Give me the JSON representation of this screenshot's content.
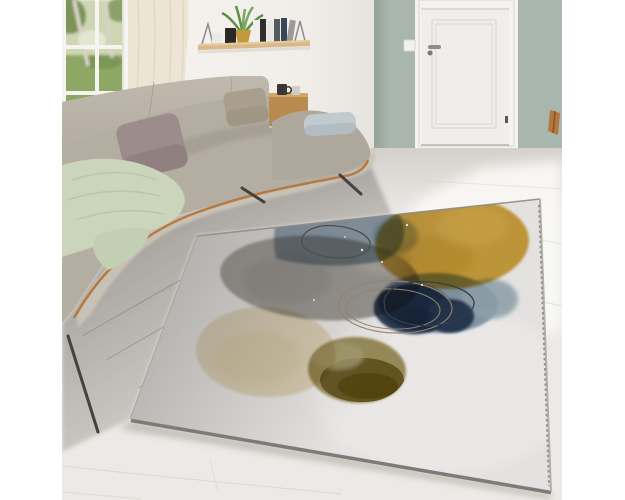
{
  "meta": {
    "alt": "Living room product photo: gray sectional sofa by a window, sage green wall with white door, and a light gray area rug with abstract watercolor circles in yellow, gray, blue, navy, cream and olive",
    "image_width": 625,
    "image_height": 500
  },
  "palette": {
    "margin": "#ffffff",
    "back_wall": "#f4f2ee",
    "accent_wall": "#a9b6ae",
    "wall_base_line": "#8e9a90",
    "floor": "#eceae6",
    "floor_seam": "#d9d6d0",
    "floor_shadow": "#76726c",
    "sunlight": "#faf9f6",
    "door": "#efeeea",
    "door_frame": "#f4f3f0",
    "door_handle": "#8f8d8a",
    "door_catch": "#5b5955",
    "light_switch": "#f2f1ee",
    "curtain": "#ece4d4",
    "curtain_fold": "#dcd1ba",
    "window_frame": "#f5f4f1",
    "window_sill": "#f3f2ef",
    "garden_light": "#cdd5b2",
    "garden_lawn": "#8fa765",
    "garden_foliage": "#7c9459",
    "tree_trunk": "#d8d3c6",
    "shelf_wood": "#d9b988",
    "shelf_bracket": "#8b8b89",
    "plant_green": "#5f8f47",
    "plant_pot": "#c2993f",
    "vase_white": "#eceae6",
    "canister_black": "#2a2928",
    "sofa_fabric": "#b4ada1",
    "sofa_chaise": "#aea79b",
    "sofa_crease": "#968f84",
    "sofa_seat_front": "#cbc4b7",
    "sofa_trim": "#b5763c",
    "sofa_leg": "#44423e",
    "pillow_mauve": "#9c8d8c",
    "pillow_taupe": "#a99f8e",
    "pillow_silver": "#c1cacd",
    "throw_green": "#cad5bb",
    "throw_fold": "#b2c0a0",
    "table_wood": "#b98a4e",
    "mug_black": "#3a3836",
    "cup_gray": "#d0cdc7",
    "chair_wood": "#b5773f",
    "rug_base": "#e4e3e1",
    "rug_edge": "#7e7b77",
    "rug_stitch": "#8a8784",
    "rug_top_line": "#8f8b86"
  },
  "shelf_books": [
    {
      "color": "#f1efeb"
    },
    {
      "color": "#2f2e2c"
    },
    {
      "color": "#e8e6e2"
    },
    {
      "color": "#56595e"
    },
    {
      "color": "#39465a"
    },
    {
      "color": "#9d9b98"
    }
  ],
  "rug_design": {
    "blue_wash": "#7f97ab",
    "blue_wash_light": "#9db1c0",
    "yellow": "#d4a63c",
    "yellow_dark": "#c08f26",
    "yellow_light": "#e2b851",
    "gray": "#a5a29e",
    "gray_dark": "#8e8b87",
    "light_blue": "#8aa0b3",
    "light_blue_pale": "#9cb0bf",
    "navy": "#2e4362",
    "navy_light": "#3c5270",
    "navy_dark": "#24344c",
    "cream": "#ecdfc0",
    "cream_dark": "#e3d2a6",
    "olive": "#a3955e",
    "olive_dark": "#695820",
    "olive_darkest": "#544508",
    "khaki_light": "#b3aa7a",
    "ring_dark": "#45474a",
    "ring_navy": "#2f3b4b",
    "ring_tan": "#93866c",
    "speckle": "#fbfaf8"
  }
}
